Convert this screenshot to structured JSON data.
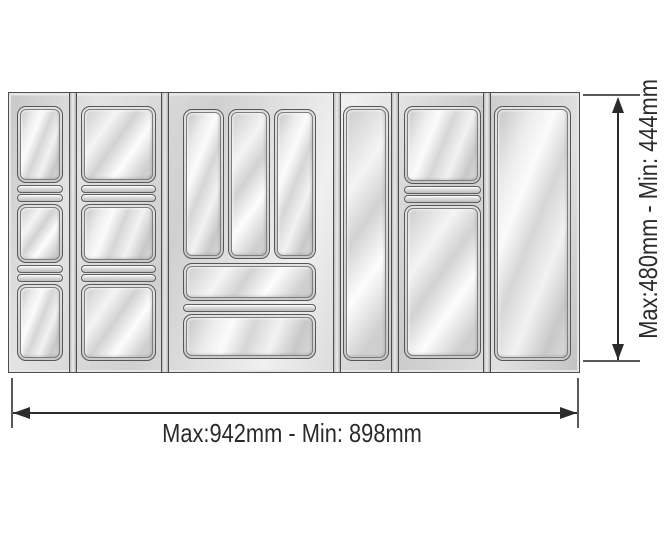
{
  "diagram": {
    "kind": "product dimension drawing",
    "subject": "silver plastic cutlery tray drawer insert with 6 modules"
  },
  "dimensions": {
    "width_label": "Max:942mm - Min: 898mm",
    "height_label": "Max:480mm - Min: 444mm"
  },
  "tray": {
    "modules": [
      {
        "id": 1,
        "description": "narrow column, 3 compartments with double divider ridges"
      },
      {
        "id": 2,
        "description": "wide column, 3 compartments with double divider ridges"
      },
      {
        "id": 3,
        "description": "center cutlery block: 3 vertical slots, shallow wide tray, wide bottom tray"
      },
      {
        "id": 4,
        "description": "narrow spacer column, single tall slot"
      },
      {
        "id": 5,
        "description": "wide column, 2 compartments with double divider ridge"
      },
      {
        "id": 6,
        "description": "wide column, single tall compartment"
      }
    ]
  },
  "colors": {
    "background": "#ffffff",
    "silver_light": "#fbfbfb",
    "silver_mid": "#d6d6d6",
    "silver_shadow": "#bcbcbc",
    "outline": "#4f4f4f",
    "dimension_line": "#2b2b2b",
    "label_text": "#2b2b2b"
  }
}
